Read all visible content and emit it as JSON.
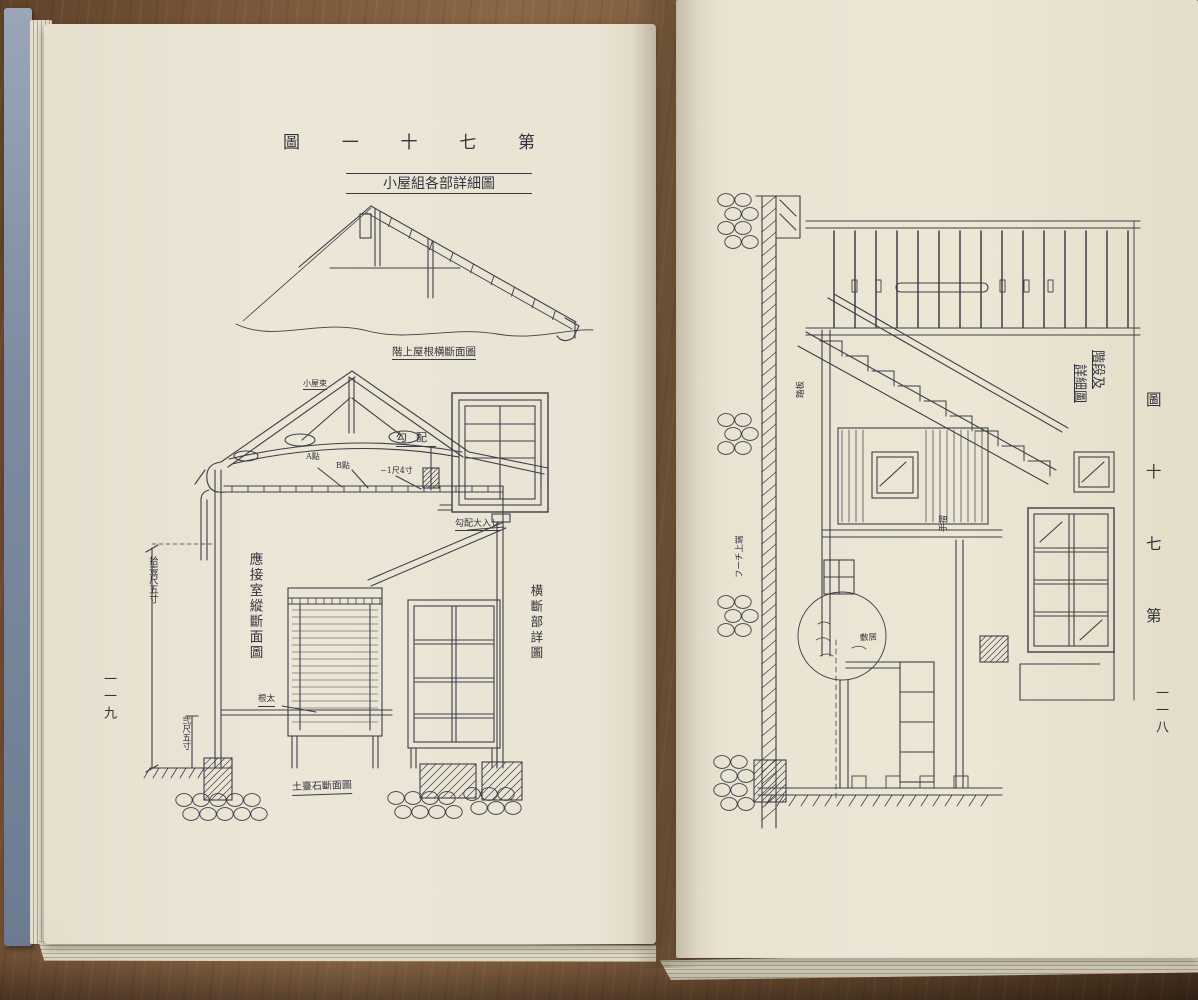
{
  "left_page": {
    "page_number": "一一九",
    "figure_chars": [
      "圖",
      "一",
      "十",
      "七",
      "第"
    ],
    "caption": "小屋組各部詳細圖",
    "labels": {
      "roof_section": "階上屋根横斷面圖",
      "koyazuka": "小屋束",
      "pitch": "勾配",
      "point_a": "A點",
      "point_b": "B點",
      "eave_dim": "−1尺4寸",
      "section_title_vertical": "應接室縱斷面圖",
      "cross_detail_vertical": "横斷部詳圖",
      "daiire": "勾配大入レ",
      "neda": "根太",
      "height_dim": "拾壹尺五寸",
      "foundation_dim": "弐尺五寸",
      "plinth_section": "土臺石斷面圖"
    }
  },
  "right_page": {
    "page_number": "一一八",
    "figure_chars": [
      "圖",
      "十",
      "七",
      "第"
    ],
    "caption_line1": "階段及",
    "caption_line2": "詳細圖",
    "labels": {
      "wall_finish": "フーチ上端",
      "handrail": "手摺",
      "tread": "踏板",
      "sill": "敷居"
    }
  }
}
